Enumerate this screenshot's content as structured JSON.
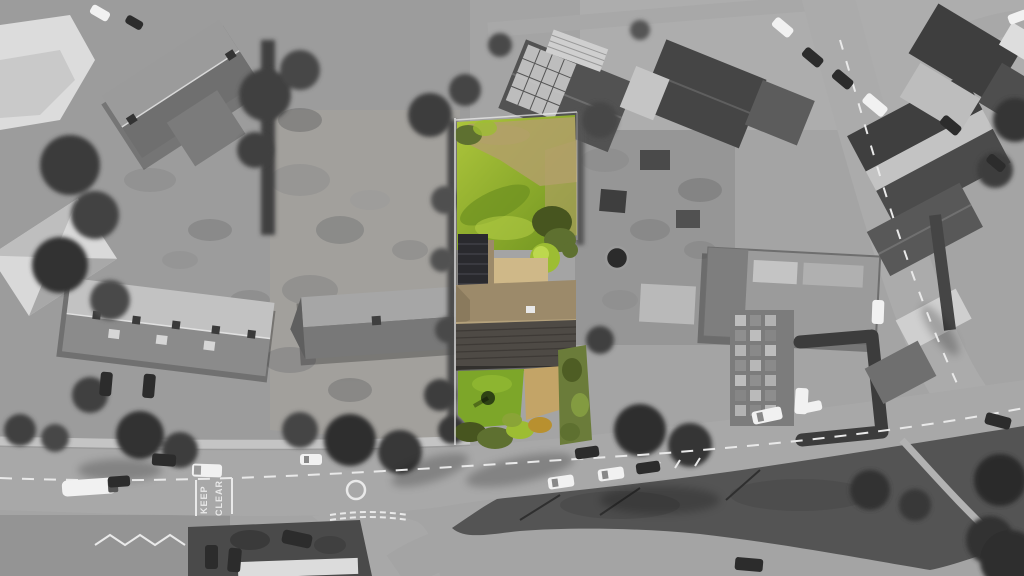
{
  "meta": {
    "scene": "aerial drone photograph of a residential street block",
    "treatment": "greyscale photograph with a single property plot highlighted in full colour",
    "highlighted_plot": {
      "label": "highlighted-property",
      "parts": [
        "rear-lawn",
        "shrub-border",
        "round-bush",
        "solar-panel-wing",
        "main-house-roof",
        "courtyard",
        "front-lawn",
        "small-tree",
        "driveway",
        "front-shrubs",
        "side-hedge"
      ]
    }
  },
  "road_text": {
    "keep": "KEEP",
    "clear": "CLEAR"
  },
  "palette": {
    "lawn_bright": "#8fb02c",
    "lawn_light": "#aec63c",
    "lawn_shadow": "#6f931f",
    "grass_dry": "#b2a069",
    "bush_olive": "#5e7030",
    "bush_dark": "#47551f",
    "bush_bright": "#9dbd33",
    "bush_autumn": "#b8902f",
    "roof_tan": "#9c8a6a",
    "roof_tan_light": "#cfb888",
    "roof_front_dark": "#4e4a45",
    "solar_panel": "#2a2a2e",
    "driveway_tan": "#c3a467",
    "hedge_olive": "#6b7c3a",
    "tree_dark_green": "#2e4214",
    "marking_white": "#e9e9e9",
    "road_gray": "#a8a8a8",
    "verge_gray": "#545454",
    "car_white": "#f1f1f1",
    "car_dark": "#2c2c2c"
  }
}
